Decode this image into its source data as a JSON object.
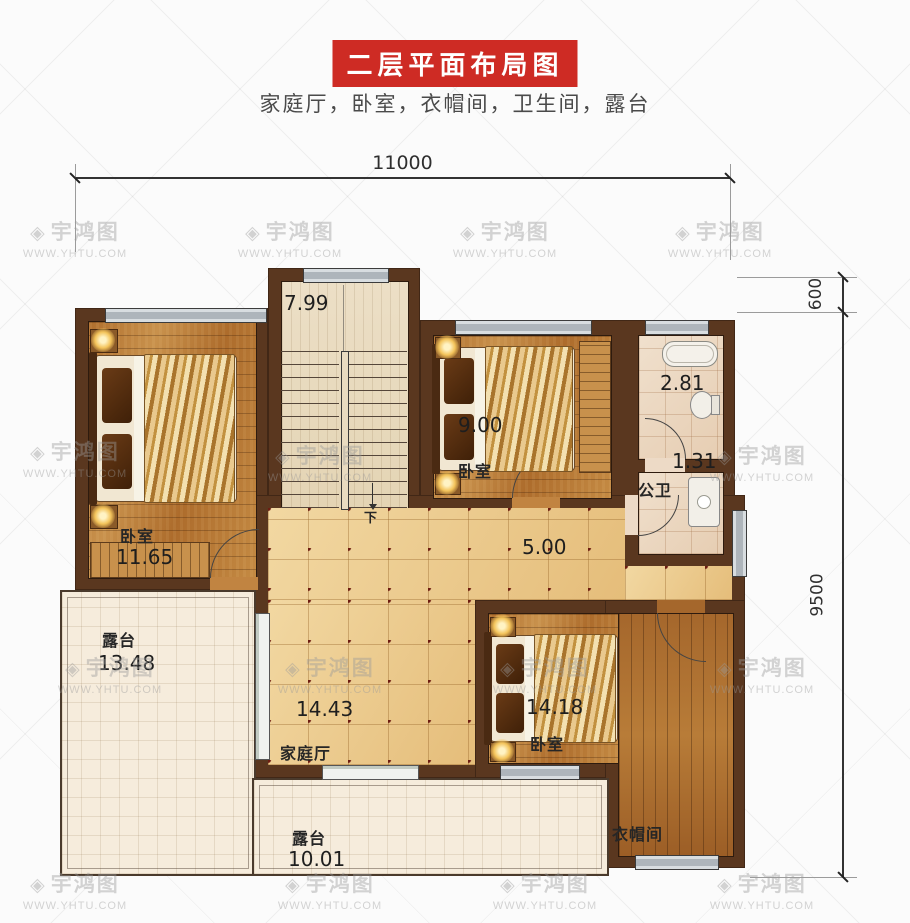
{
  "header": {
    "title": "二层平面布局图",
    "subtitle": "家庭厅，卧室，衣帽间，卫生间，露台"
  },
  "dimensions": {
    "width_total": "11000",
    "right_top": "600",
    "right_main": "9500"
  },
  "rooms": {
    "stairwell": {
      "area": "7.99",
      "direction": "下"
    },
    "bedroom_left": {
      "name": "卧室",
      "area": "11.65"
    },
    "bedroom_middle": {
      "name": "卧室",
      "area": "9.00"
    },
    "bathroom": {
      "area": "2.81"
    },
    "public_toilet": {
      "name": "公卫",
      "area": "1.31"
    },
    "hallway": {
      "area": "5.00"
    },
    "family_hall": {
      "name": "家庭厅",
      "area": "14.43"
    },
    "bedroom_right": {
      "name": "卧室",
      "area": "14.18"
    },
    "cloakroom": {
      "name": "衣帽间"
    },
    "terrace_left": {
      "name": "露台",
      "area": "13.48"
    },
    "terrace_bottom": {
      "name": "露台",
      "area": "10.01"
    }
  },
  "watermark": {
    "brand": "宇鸿图",
    "site": "WWW.YHTU.COM",
    "icon_glyph": "◈"
  },
  "colors": {
    "banner_bg": "#ce2b24",
    "wall": "#5a371f",
    "tile_accent": "#6d1d12",
    "wood_floor": "#b97c3d",
    "window_gray": "#aeb5bb",
    "terrace_floor": "#f6ecdc"
  }
}
